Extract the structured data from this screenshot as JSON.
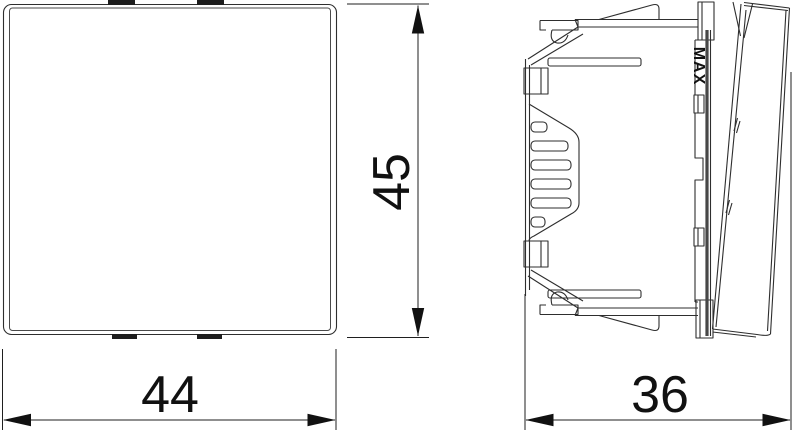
{
  "drawing": {
    "type": "technical-dimension-drawing",
    "views": {
      "front_view": {
        "name": "front view of device module"
      },
      "side_view": {
        "name": "side profile of device module with mounting claws",
        "max_label": "MAX"
      }
    }
  },
  "dimensions": {
    "front_width": "44",
    "front_height": "45",
    "side_depth": "36"
  },
  "colors": {
    "background": "#ffffff",
    "line": "#2e2e2e",
    "dimension_line": "#1f1f1f",
    "text": "#111111",
    "tab_fill": "#1d1d1d"
  }
}
